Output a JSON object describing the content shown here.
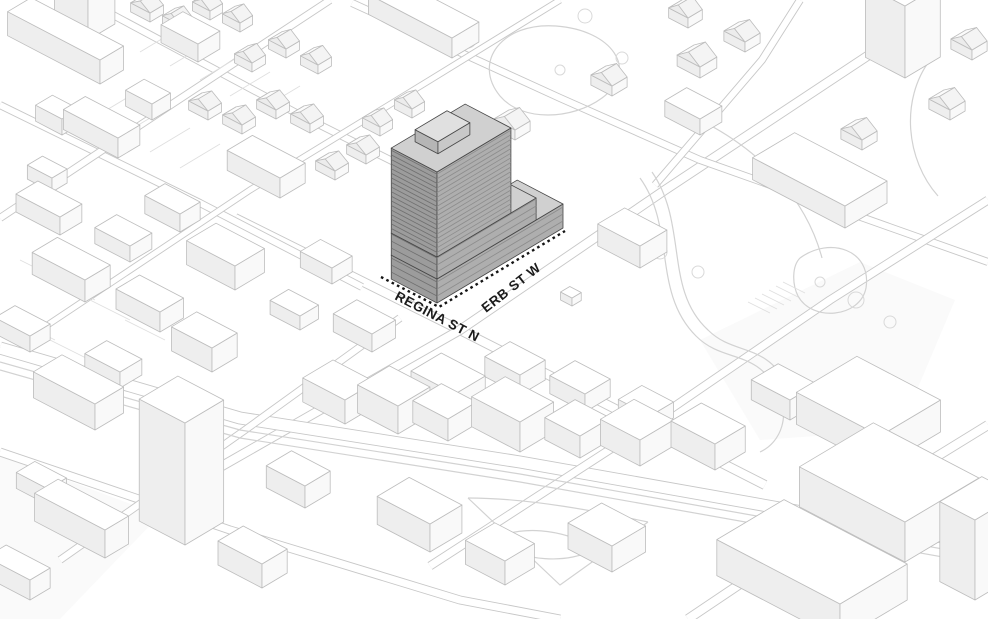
{
  "view": {
    "title": "3d-axonometric-site-context-massing-diagram",
    "width": 988,
    "height": 619
  },
  "labels": {
    "regina": "REGINA ST N",
    "erb": "ERB ST W"
  },
  "colors": {
    "bg": "#ffffff",
    "road_casing": "#c7c7c7",
    "road_fill": "#ffffff",
    "curve": "#d2d2d2",
    "thin": "#dfdfdf",
    "tree": "#d9d9d9",
    "patch": "#f5f5f5",
    "block_stroke": "#bdbdbd",
    "block_top": "#ffffff",
    "block_left": "#eeeeee",
    "block_right": "#f9f9f9",
    "roof_front": "#f4f4f4",
    "roof_back": "#fbfbfb",
    "gable": "#ececec",
    "site_stroke": "#474747",
    "site_left": "#9c9c9c",
    "site_right": "#aeaeae",
    "site_top": "#d0d0d0",
    "site_stripe_left": "#6f6f6f",
    "site_stripe_right": "#8c8c8c",
    "ph_left": "#b5b5b5",
    "ph_right": "#c8c8c8",
    "ph_top": "#e0e0e0",
    "dash": "#141414",
    "label": "#1b1b1b"
  },
  "basis": {
    "a": [
      0.88,
      0.46
    ],
    "b": [
      0.84,
      -0.5
    ]
  },
  "site": {
    "name": "proposed-tower-massing",
    "origin": [
      437,
      303
    ],
    "tiers": [
      {
        "o": [
          0,
          0
        ],
        "a": 52,
        "b": 150,
        "h": 24,
        "z": 0,
        "s": 7
      },
      {
        "o": [
          0,
          0
        ],
        "a": 52,
        "b": 118,
        "h": 22,
        "z": 24,
        "s": 7
      },
      {
        "o": [
          0,
          0
        ],
        "a": 52,
        "b": 88,
        "h": 85,
        "z": 46,
        "s": 4.6
      },
      {
        "o": [
          18,
          20
        ],
        "a": 26,
        "b": 38,
        "h": 12,
        "z": 131,
        "light": true
      }
    ],
    "dash": [
      [
        381,
        277
      ],
      [
        439,
        307
      ],
      [
        565,
        231
      ]
    ]
  },
  "scene": {
    "ground_patches": [
      {
        "pts": [
          [
            0,
            455
          ],
          [
            160,
            515
          ],
          [
            60,
            619
          ],
          [
            0,
            619
          ]
        ]
      },
      {
        "pts": [
          [
            700,
            340
          ],
          [
            860,
            262
          ],
          [
            955,
            300
          ],
          [
            900,
            430
          ],
          [
            760,
            440
          ]
        ]
      }
    ],
    "roads": [
      {
        "name": "regina-st-n",
        "w": 10,
        "pts": [
          [
            235,
            218
          ],
          [
            460,
            330
          ],
          [
            765,
            485
          ]
        ]
      },
      {
        "name": "erb-st-w",
        "w": 10,
        "pts": [
          [
            215,
            470
          ],
          [
            460,
            330
          ],
          [
            665,
            190
          ],
          [
            884,
            45
          ]
        ]
      },
      {
        "name": "main-street-center",
        "w": 13,
        "pts": [
          [
            0,
            348
          ],
          [
            240,
            418
          ],
          [
            520,
            462
          ],
          [
            988,
            545
          ]
        ]
      },
      {
        "name": "street-north",
        "w": 8,
        "pts": [
          [
            352,
            3
          ],
          [
            560,
            98
          ],
          [
            700,
            160
          ],
          [
            988,
            262
          ]
        ]
      },
      {
        "name": "street-northwest",
        "w": 8,
        "pts": [
          [
            0,
            105
          ],
          [
            200,
            203
          ],
          [
            362,
            287
          ]
        ]
      },
      {
        "name": "street-topleft",
        "w": 8,
        "pts": [
          [
            85,
            0
          ],
          [
            300,
            115
          ],
          [
            460,
            195
          ]
        ]
      },
      {
        "name": "street-southwest",
        "w": 9,
        "pts": [
          [
            0,
            452
          ],
          [
            230,
            530
          ],
          [
            460,
            600
          ],
          [
            560,
            619
          ]
        ]
      },
      {
        "name": "street-b2",
        "w": 8,
        "pts": [
          [
            60,
            560
          ],
          [
            245,
            430
          ],
          [
            400,
            318
          ]
        ]
      },
      {
        "name": "street-b3",
        "w": 9,
        "pts": [
          [
            430,
            566
          ],
          [
            640,
            430
          ],
          [
            830,
            300
          ],
          [
            988,
            200
          ]
        ]
      },
      {
        "name": "street-b4",
        "w": 8,
        "pts": [
          [
            0,
            218
          ],
          [
            160,
            112
          ],
          [
            330,
            0
          ]
        ]
      },
      {
        "name": "street-b5",
        "w": 7,
        "pts": [
          [
            40,
            330
          ],
          [
            250,
            190
          ],
          [
            430,
            80
          ],
          [
            560,
            0
          ]
        ]
      },
      {
        "name": "street-b6",
        "w": 10,
        "pts": [
          [
            688,
            619
          ],
          [
            850,
            510
          ],
          [
            988,
            425
          ]
        ]
      },
      {
        "name": "street-topright",
        "w": 8,
        "pts": [
          [
            655,
            185
          ],
          [
            762,
            60
          ],
          [
            800,
            0
          ]
        ]
      }
    ],
    "curves": [
      "M500,96 C472,62 502,22 556,26 C612,30 640,70 602,98 C572,120 522,122 500,96",
      "M640,178 C676,228 652,292 696,336 C724,364 756,348 778,392 C790,414 782,442 760,452",
      "M652,172 C688,224 664,290 708,330 C734,356 766,342 788,386",
      "M800,258 C830,236 872,250 866,288 C860,318 812,322 798,296 C792,284 792,266 800,258",
      "M700,120 C760,150 806,198 822,258",
      "M930,60 C900,100 906,160 938,196",
      "M468,498 C530,498 600,512 648,522",
      "M468,498 L560,585 L648,522",
      "M492,540 C520,525 560,528 596,548 C570,565 520,562 492,540",
      "M0,362 L240,430 L520,474 L988,557",
      "M0,370 L240,438 L520,482 L988,565"
    ],
    "thin_lines": [
      [
        748,
        302,
        770,
        313
      ],
      [
        755,
        298,
        777,
        309
      ],
      [
        762,
        294,
        784,
        305
      ],
      [
        769,
        290,
        791,
        301
      ],
      [
        776,
        286,
        798,
        297
      ],
      [
        783,
        282,
        805,
        293
      ],
      [
        140,
        52,
        180,
        28
      ],
      [
        170,
        66,
        210,
        42
      ],
      [
        200,
        80,
        240,
        56
      ],
      [
        230,
        96,
        270,
        72
      ],
      [
        260,
        110,
        300,
        86
      ],
      [
        90,
        120,
        130,
        96
      ],
      [
        120,
        136,
        160,
        112
      ],
      [
        150,
        152,
        190,
        128
      ],
      [
        180,
        168,
        220,
        144
      ],
      [
        20,
        260,
        60,
        280
      ],
      [
        55,
        280,
        95,
        300
      ],
      [
        90,
        300,
        130,
        320
      ],
      [
        125,
        320,
        165,
        340
      ],
      [
        15,
        320,
        55,
        340
      ],
      [
        50,
        340,
        90,
        360
      ]
    ],
    "trees": [
      {
        "x": 468,
        "y": 40,
        "r": 8
      },
      {
        "x": 585,
        "y": 16,
        "r": 7
      },
      {
        "x": 622,
        "y": 58,
        "r": 6
      },
      {
        "x": 560,
        "y": 70,
        "r": 5
      },
      {
        "x": 660,
        "y": 252,
        "r": 7
      },
      {
        "x": 698,
        "y": 272,
        "r": 6
      },
      {
        "x": 856,
        "y": 300,
        "r": 8
      },
      {
        "x": 890,
        "y": 322,
        "r": 6
      },
      {
        "x": 820,
        "y": 282,
        "r": 5
      }
    ],
    "blocks": [
      {
        "f": [
          100,
          84
        ],
        "a": 105,
        "b": 28,
        "h": 24
      },
      {
        "f": [
          88,
          40
        ],
        "a": 38,
        "b": 32,
        "h": 52
      },
      {
        "f": [
          62,
          135
        ],
        "a": 30,
        "b": 20,
        "h": 16
      },
      {
        "f": [
          118,
          158
        ],
        "a": 62,
        "b": 26,
        "h": 20
      },
      {
        "f": [
          52,
          192
        ],
        "a": 28,
        "b": 18,
        "h": 14
      },
      {
        "f": [
          198,
          62
        ],
        "a": 42,
        "b": 26,
        "h": 18
      },
      {
        "f": [
          152,
          120
        ],
        "a": 30,
        "b": 22,
        "h": 16
      },
      {
        "f": [
          280,
          198
        ],
        "a": 60,
        "b": 30,
        "h": 20
      },
      {
        "f": [
          180,
          232
        ],
        "a": 40,
        "b": 24,
        "h": 18
      },
      {
        "f": [
          452,
          58
        ],
        "a": 95,
        "b": 32,
        "h": 20
      },
      {
        "f": [
          150,
          22
        ],
        "a": 22,
        "b": 16,
        "h": 9,
        "r": 7
      },
      {
        "f": [
          180,
          34
        ],
        "a": 20,
        "b": 15,
        "h": 9,
        "r": 7
      },
      {
        "f": [
          210,
          20
        ],
        "a": 20,
        "b": 15,
        "h": 9,
        "r": 7
      },
      {
        "f": [
          240,
          32
        ],
        "a": 20,
        "b": 15,
        "h": 9,
        "r": 7
      },
      {
        "f": [
          252,
          72
        ],
        "a": 20,
        "b": 16,
        "h": 9,
        "r": 7
      },
      {
        "f": [
          286,
          58
        ],
        "a": 20,
        "b": 16,
        "h": 9,
        "r": 7
      },
      {
        "f": [
          318,
          74
        ],
        "a": 20,
        "b": 16,
        "h": 9,
        "r": 7
      },
      {
        "f": [
          208,
          120
        ],
        "a": 22,
        "b": 16,
        "h": 9,
        "r": 7
      },
      {
        "f": [
          242,
          134
        ],
        "a": 22,
        "b": 16,
        "h": 9,
        "r": 7
      },
      {
        "f": [
          276,
          119
        ],
        "a": 22,
        "b": 16,
        "h": 9,
        "r": 7
      },
      {
        "f": [
          310,
          133
        ],
        "a": 22,
        "b": 16,
        "h": 9,
        "r": 7
      },
      {
        "f": [
          335,
          180
        ],
        "a": 22,
        "b": 16,
        "h": 9,
        "r": 7
      },
      {
        "f": [
          366,
          164
        ],
        "a": 22,
        "b": 16,
        "h": 9,
        "r": 7
      },
      {
        "f": [
          380,
          136
        ],
        "a": 20,
        "b": 15,
        "h": 9,
        "r": 7
      },
      {
        "f": [
          412,
          118
        ],
        "a": 20,
        "b": 15,
        "h": 9,
        "r": 7
      },
      {
        "f": [
          515,
          140
        ],
        "a": 24,
        "b": 18,
        "h": 10,
        "r": 8
      },
      {
        "f": [
          612,
          96
        ],
        "a": 24,
        "b": 18,
        "h": 10,
        "r": 8
      },
      {
        "f": [
          700,
          78
        ],
        "a": 26,
        "b": 20,
        "h": 11,
        "r": 9
      },
      {
        "f": [
          745,
          52
        ],
        "a": 24,
        "b": 18,
        "h": 10,
        "r": 8
      },
      {
        "f": [
          688,
          28
        ],
        "a": 22,
        "b": 17,
        "h": 10,
        "r": 8
      },
      {
        "f": [
          810,
          182
        ],
        "a": 30,
        "b": 22,
        "h": 11,
        "r": 9
      },
      {
        "f": [
          862,
          150
        ],
        "a": 24,
        "b": 18,
        "h": 10,
        "r": 8
      },
      {
        "f": [
          905,
          78
        ],
        "a": 45,
        "b": 42,
        "h": 72
      },
      {
        "f": [
          950,
          120
        ],
        "a": 24,
        "b": 18,
        "h": 10,
        "r": 8
      },
      {
        "f": [
          972,
          60
        ],
        "a": 24,
        "b": 18,
        "h": 10,
        "r": 8
      },
      {
        "f": [
          640,
          268
        ],
        "a": 48,
        "b": 32,
        "h": 22
      },
      {
        "f": [
          845,
          228
        ],
        "a": 105,
        "b": 50,
        "h": 22
      },
      {
        "f": [
          572,
          306
        ],
        "a": 13,
        "b": 11,
        "h": 8
      },
      {
        "f": [
          700,
          135
        ],
        "a": 40,
        "b": 26,
        "h": 16
      },
      {
        "f": [
          85,
          302
        ],
        "a": 60,
        "b": 30,
        "h": 22
      },
      {
        "f": [
          60,
          235
        ],
        "a": 50,
        "b": 26,
        "h": 18
      },
      {
        "f": [
          160,
          332
        ],
        "a": 50,
        "b": 28,
        "h": 20
      },
      {
        "f": [
          235,
          290
        ],
        "a": 55,
        "b": 35,
        "h": 24
      },
      {
        "f": [
          130,
          262
        ],
        "a": 40,
        "b": 26,
        "h": 16
      },
      {
        "f": [
          30,
          352
        ],
        "a": 40,
        "b": 24,
        "h": 16
      },
      {
        "f": [
          212,
          372
        ],
        "a": 46,
        "b": 30,
        "h": 24
      },
      {
        "f": [
          120,
          388
        ],
        "a": 40,
        "b": 26,
        "h": 16
      },
      {
        "f": [
          332,
          284
        ],
        "a": 36,
        "b": 24,
        "h": 16
      },
      {
        "f": [
          300,
          330
        ],
        "a": 34,
        "b": 22,
        "h": 14
      },
      {
        "f": [
          372,
          352
        ],
        "a": 44,
        "b": 28,
        "h": 18
      },
      {
        "f": [
          455,
          418
        ],
        "a": 50,
        "b": 36,
        "h": 24
      },
      {
        "f": [
          345,
          424
        ],
        "a": 48,
        "b": 36,
        "h": 24
      },
      {
        "f": [
          398,
          434
        ],
        "a": 46,
        "b": 38,
        "h": 28
      },
      {
        "f": [
          448,
          441
        ],
        "a": 40,
        "b": 34,
        "h": 22
      },
      {
        "f": [
          520,
          452
        ],
        "a": 55,
        "b": 40,
        "h": 30
      },
      {
        "f": [
          580,
          458
        ],
        "a": 40,
        "b": 36,
        "h": 22
      },
      {
        "f": [
          640,
          466
        ],
        "a": 45,
        "b": 40,
        "h": 26
      },
      {
        "f": [
          520,
          395
        ],
        "a": 40,
        "b": 30,
        "h": 20
      },
      {
        "f": [
          585,
          412
        ],
        "a": 40,
        "b": 30,
        "h": 18
      },
      {
        "f": [
          650,
          432
        ],
        "a": 36,
        "b": 28,
        "h": 16
      },
      {
        "f": [
          715,
          470
        ],
        "a": 50,
        "b": 36,
        "h": 26
      },
      {
        "f": [
          790,
          420
        ],
        "a": 44,
        "b": 32,
        "h": 20
      },
      {
        "f": [
          185,
          545
        ],
        "a": 52,
        "b": 46,
        "h": 122
      },
      {
        "f": [
          105,
          558
        ],
        "a": 80,
        "b": 28,
        "h": 28
      },
      {
        "f": [
          95,
          430
        ],
        "a": 70,
        "b": 34,
        "h": 26
      },
      {
        "f": [
          30,
          600
        ],
        "a": 50,
        "b": 24,
        "h": 20
      },
      {
        "f": [
          262,
          588
        ],
        "a": 50,
        "b": 30,
        "h": 24
      },
      {
        "f": [
          305,
          508
        ],
        "a": 44,
        "b": 30,
        "h": 22
      },
      {
        "f": [
          48,
          505
        ],
        "a": 36,
        "b": 22,
        "h": 16
      },
      {
        "f": [
          430,
          552
        ],
        "a": 60,
        "b": 38,
        "h": 28
      },
      {
        "f": [
          505,
          585
        ],
        "a": 45,
        "b": 35,
        "h": 24
      },
      {
        "f": [
          612,
          572
        ],
        "a": 50,
        "b": 40,
        "h": 26
      },
      {
        "f": [
          880,
          468
        ],
        "a": 95,
        "b": 72,
        "h": 32
      },
      {
        "f": [
          905,
          562
        ],
        "a": 120,
        "b": 88,
        "h": 40
      },
      {
        "f": [
          840,
          640
        ],
        "a": 140,
        "b": 80,
        "h": 36
      },
      {
        "f": [
          975,
          600
        ],
        "a": 40,
        "b": 50,
        "h": 80
      }
    ]
  }
}
